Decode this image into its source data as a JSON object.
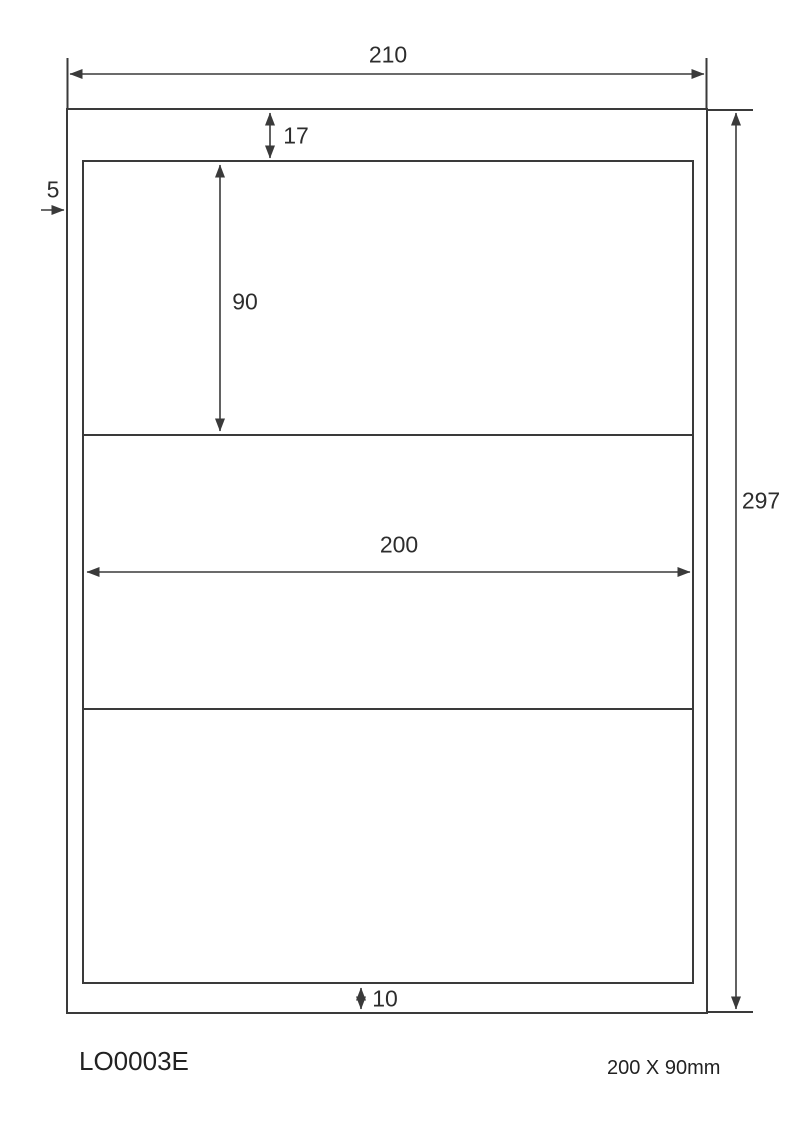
{
  "diagram": {
    "type": "label-sheet-dimension-drawing",
    "dimensions": {
      "sheet_width": "210",
      "sheet_height": "297",
      "top_margin": "17",
      "label_height": "90",
      "label_width": "200",
      "bottom_margin": "10",
      "left_margin": "5"
    },
    "footer": {
      "product_code": "LO0003E",
      "label_size": "200 X 90mm"
    },
    "labels_count": 3,
    "colors": {
      "line": "#3a3a3a",
      "text": "#2d2d2d",
      "background": "#ffffff"
    }
  }
}
